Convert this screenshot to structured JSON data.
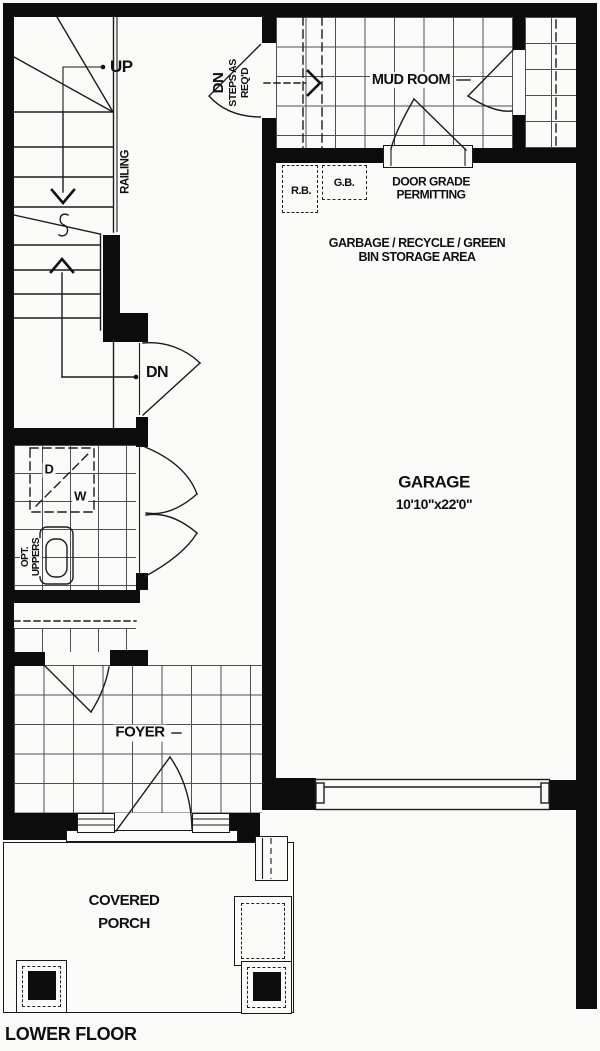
{
  "colors": {
    "bg": "#fafaf8",
    "wall": "#0c0c0c",
    "line": "#1c1c1c",
    "tile": "#4f4f4f"
  },
  "title": {
    "floor": "LOWER FLOOR"
  },
  "rooms": {
    "mud_room": {
      "name": "MUD ROOM"
    },
    "garage": {
      "name": "GARAGE",
      "dims": "10'10\"x22'0\""
    },
    "foyer": {
      "name": "FOYER"
    },
    "covered_porch": {
      "line1": "COVERED",
      "line2": "PORCH"
    }
  },
  "stairs": {
    "up": "UP",
    "dn": "DN",
    "railing": "RAILING"
  },
  "notes": {
    "dn_steps": {
      "line1": "DN",
      "line2": "STEPS AS",
      "line3": "REQ'D"
    },
    "door_grade": {
      "line1": "DOOR GRADE",
      "line2": "PERMITTING"
    },
    "garbage": {
      "line1": "GARBAGE / RECYCLE / GREEN",
      "line2": "BIN STORAGE AREA"
    },
    "opt_uppers": {
      "line1": "OPT.",
      "line2": "UPPERS"
    }
  },
  "fixtures": {
    "recycle_bin": "R.B.",
    "green_bin": "G.B.",
    "dryer": "D",
    "washer": "W"
  }
}
